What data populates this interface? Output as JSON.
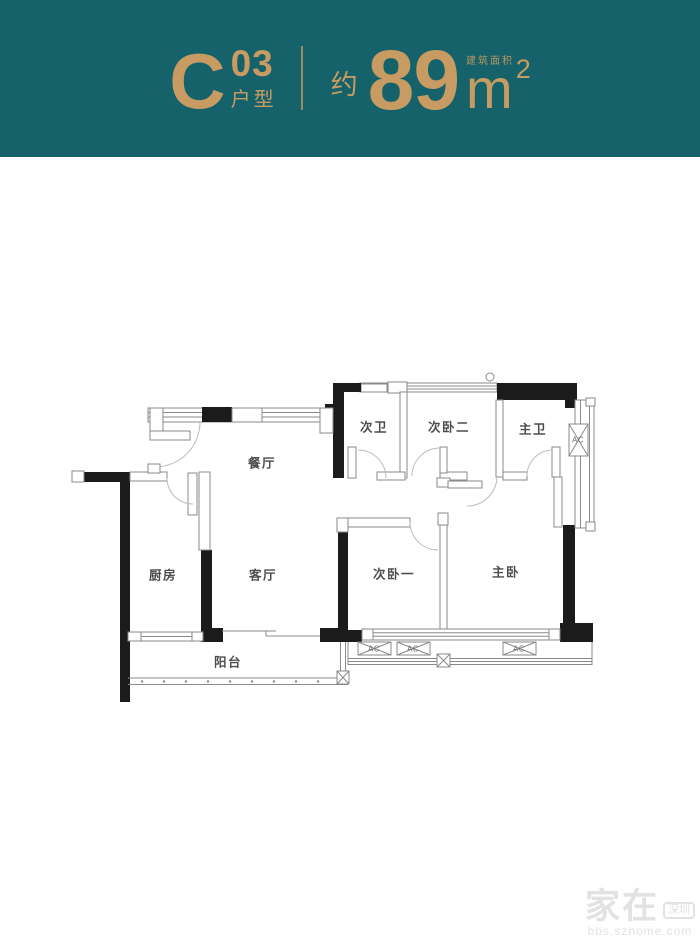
{
  "header": {
    "unit_letter": "C",
    "unit_number": "03",
    "unit_type_label": "户型",
    "approx_label": "约",
    "area_value": "89",
    "area_unit": "m",
    "area_exponent": "2",
    "area_caption": "建筑面积",
    "colors": {
      "banner_bg": "#16626a",
      "accent_gold": "#c89b62"
    }
  },
  "floorplan": {
    "rooms": [
      {
        "id": "dining",
        "label": "餐厅",
        "x": 262,
        "y": 462
      },
      {
        "id": "kitchen",
        "label": "厨房",
        "x": 163,
        "y": 574
      },
      {
        "id": "living",
        "label": "客厅",
        "x": 263,
        "y": 574
      },
      {
        "id": "balcony",
        "label": "阳台",
        "x": 228,
        "y": 661
      },
      {
        "id": "bath-2",
        "label": "次卫",
        "x": 374,
        "y": 426
      },
      {
        "id": "bedroom-2",
        "label": "次卧二",
        "x": 449,
        "y": 426
      },
      {
        "id": "master-bath",
        "label": "主卫",
        "x": 533,
        "y": 428
      },
      {
        "id": "bedroom-1",
        "label": "次卧一",
        "x": 394,
        "y": 573
      },
      {
        "id": "master-bedroom",
        "label": "主卧",
        "x": 506,
        "y": 571
      }
    ],
    "ac_units": [
      {
        "label": "AC",
        "x": 578,
        "y": 440
      },
      {
        "label": "AC",
        "x": 374,
        "y": 649
      },
      {
        "label": "AC",
        "x": 413,
        "y": 649
      },
      {
        "label": "AC",
        "x": 519,
        "y": 649
      }
    ],
    "colors": {
      "wall": "#1b1b1b",
      "thin_line": "#8a8a8a",
      "room_text": "#4d4d4d"
    }
  },
  "watermark": {
    "brand": "家在",
    "city_tag": "深圳",
    "site": "bbs.szhome.com",
    "color": "#e2e2e2"
  }
}
